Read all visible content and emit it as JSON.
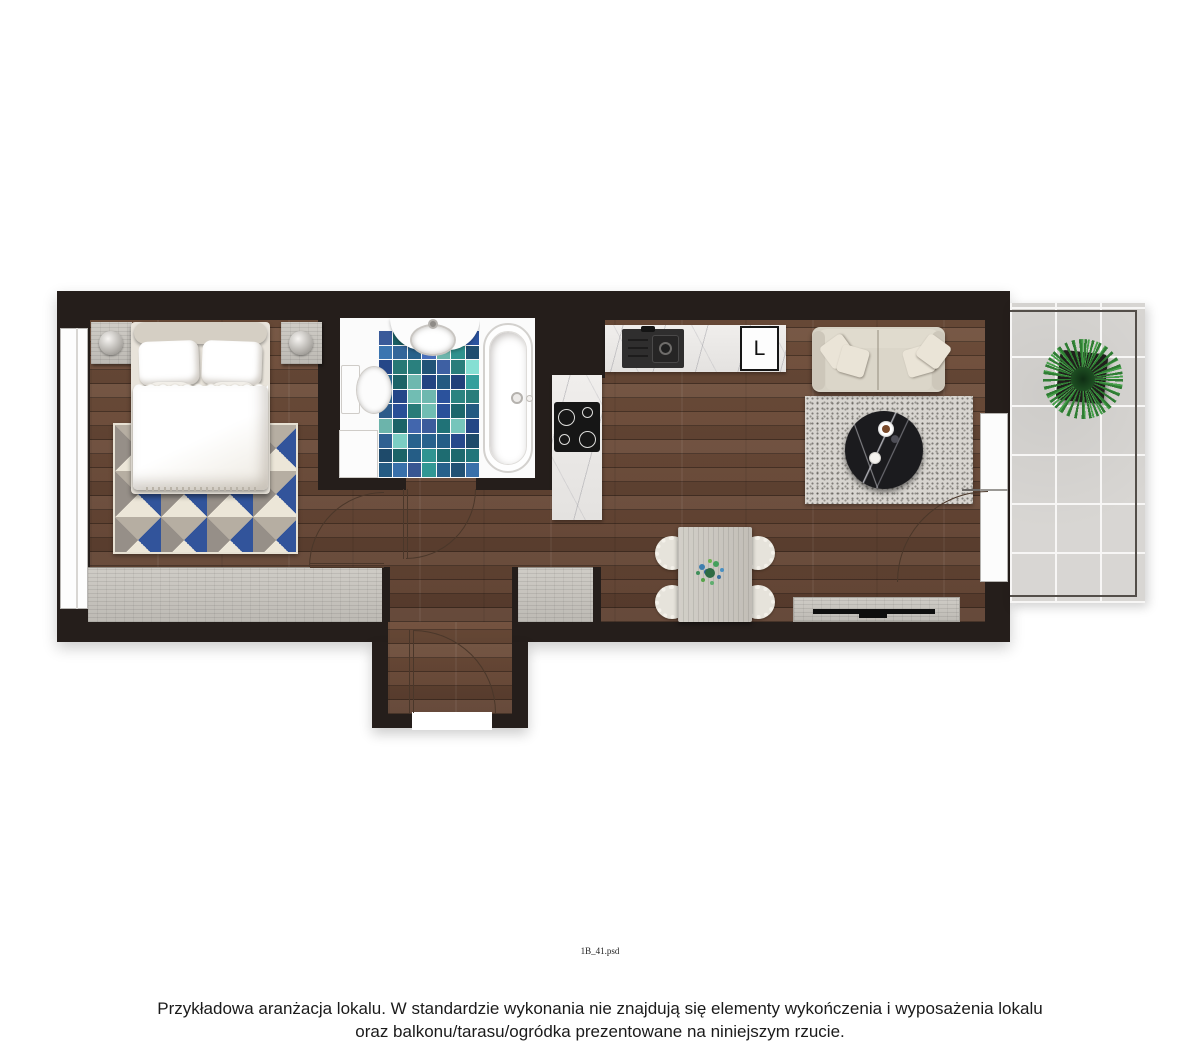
{
  "footer": {
    "filename": "1B_41.psd",
    "disclaimer_line1": "Przykładowa aranżacja lokalu. W standardzie wykonania nie znajdują się elementy wykończenia i wyposażenia lokalu",
    "disclaimer_line2": "oraz balkonu/tarasu/ogródka prezentowane na niniejszym rzucie."
  },
  "kitchen": {
    "fridge_label": "L"
  },
  "palette": {
    "wall": "#251e1b",
    "floor_wood": "#6d4a37",
    "wardrobe_wood": "#c9c6c0",
    "marble": "#eceae8",
    "balcony_tile": "#d8d6d3",
    "rug_navy": "#32549b",
    "rug_cream": "#ece6d8",
    "rug_gray": "#968f88",
    "rug_taupe": "#b6aea2",
    "plant_green": "#2f7d33",
    "mosaic": [
      "#2e8d8a",
      "#2b5fae",
      "#274b8f",
      "#3fae8f",
      "#7fd4c9",
      "#4a7a9e",
      "#1f6f74",
      "#9fd8cf",
      "#35699f",
      "#57b7a8",
      "#23577d",
      "#6fc3b2",
      "#4063a8",
      "#2c7f6a"
    ]
  }
}
